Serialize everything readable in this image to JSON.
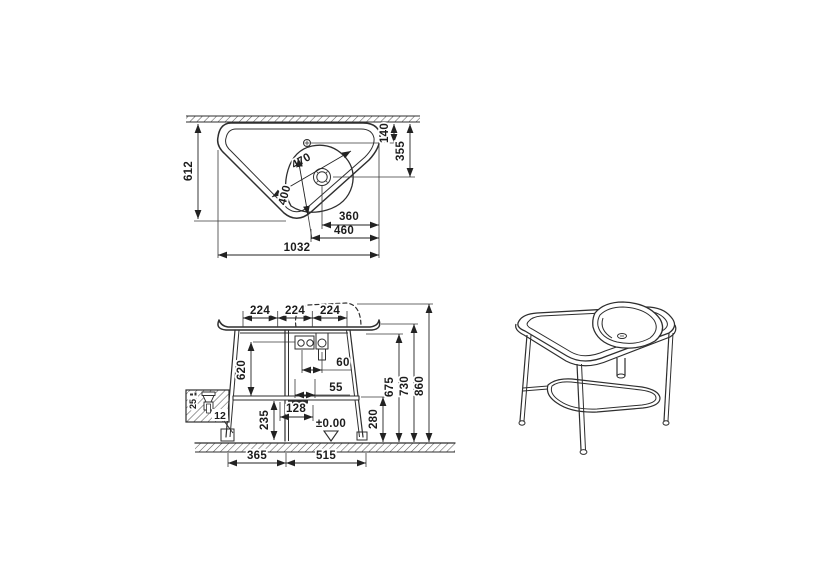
{
  "top_view": {
    "depth": "612",
    "wall_to_tap": "140",
    "wall_to_drain": "355",
    "bowl_length": "470",
    "bowl_width": "400",
    "drain_to_edge": "360",
    "tap_to_edge": "460",
    "overall_width": "1032"
  },
  "front_view": {
    "spacing_left": "224",
    "spacing_mid": "224",
    "spacing_right": "224",
    "leg_height": "620",
    "tap_offset": "60",
    "drain_offset": "55",
    "shelf_offset": "128",
    "foot_height": "235",
    "shelf_height": "280",
    "underside_height": "675",
    "counter_height": "730",
    "overall_height": "860",
    "leg_span_left": "365",
    "leg_span_right": "515",
    "datum": "±0.00"
  },
  "detail": {
    "adjust_range": "25",
    "callout": "12"
  }
}
